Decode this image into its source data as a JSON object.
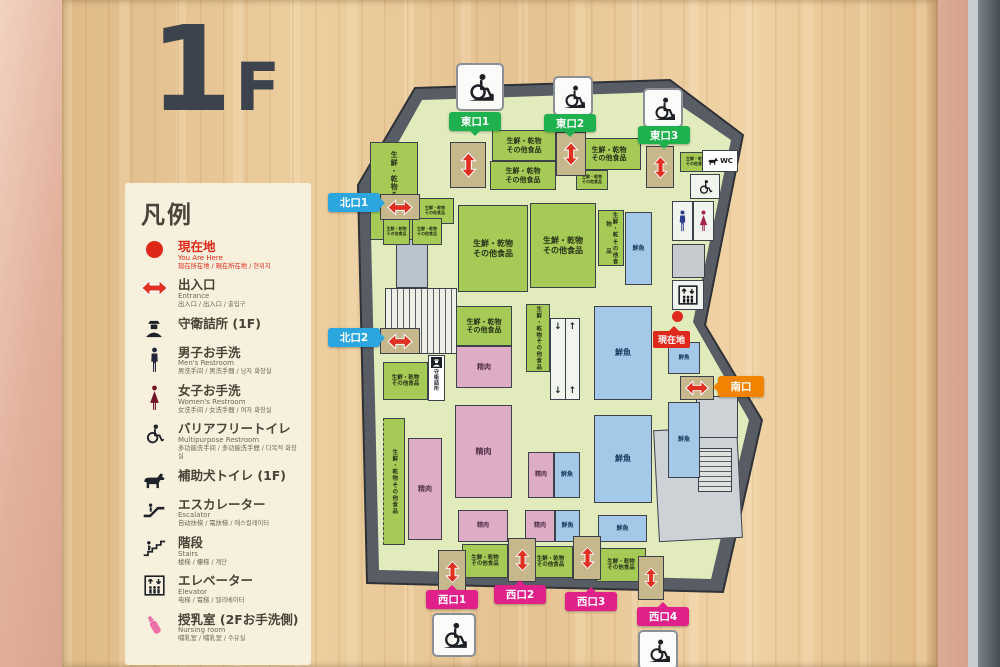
{
  "floor": {
    "big": "1",
    "small": "F"
  },
  "legend": {
    "title": "凡例",
    "items": [
      {
        "icon": "current-location",
        "label": "現在地",
        "sub_en": "You Are Here",
        "sub_multi": "现在所在地 / 現在所在地 / 현위치"
      },
      {
        "icon": "entrance",
        "label": "出入口",
        "sub_en": "Entrance",
        "sub_multi": "出入口 / 出入口 / 출입구"
      },
      {
        "icon": "guard",
        "label": "守衛詰所 (1F)"
      },
      {
        "icon": "mens-restroom",
        "label": "男子お手洗",
        "sub_en": "Men's Restroom",
        "sub_multi": "男洗手间 / 男洗手間 / 남자 화장실"
      },
      {
        "icon": "womens-restroom",
        "label": "女子お手洗",
        "sub_en": "Women's Restroom",
        "sub_multi": "女洗手间 / 女洗手間 / 여자 화장실"
      },
      {
        "icon": "barrier-free",
        "label": "バリアフリートイレ",
        "sub_en": "Multipurpose Restroom",
        "sub_multi": "多功能洗手间 / 多功能洗手間 / 다목적 화장실"
      },
      {
        "icon": "assist-dog",
        "label": "補助犬トイレ (1F)"
      },
      {
        "icon": "escalator",
        "label": "エスカレーター",
        "sub_en": "Escalator",
        "sub_multi": "自动扶梯 / 電扶梯 / 에스컬레이터"
      },
      {
        "icon": "stairs",
        "label": "階段",
        "sub_en": "Stairs",
        "sub_multi": "楼梯 / 樓梯 / 계단"
      },
      {
        "icon": "elevator",
        "label": "エレベーター",
        "sub_en": "Elevator",
        "sub_multi": "电梯 / 電梯 / 엘리베이터"
      },
      {
        "icon": "nursing",
        "label": "授乳室 (2Fお手洗側)",
        "sub_en": "Nursing room",
        "sub_multi": "哺乳室 / 哺乳室 / 수유실"
      }
    ]
  },
  "map": {
    "current_location": "現在地",
    "exits": {
      "east": [
        "東口1",
        "東口2",
        "東口3"
      ],
      "north": [
        "北口1",
        "北口2"
      ],
      "west": [
        "西口1",
        "西口2",
        "西口3",
        "西口4"
      ],
      "south": [
        "南口"
      ]
    },
    "areas": {
      "fresh1": "生鮮・乾物",
      "fresh2": "その他食品",
      "meat": "精肉",
      "fish": "鮮魚",
      "guard": "守衛詰所",
      "wc": "WC"
    },
    "colors": {
      "fresh_area": "#a5ca55",
      "meat_area": "#dfacc6",
      "fish_area": "#a3c8e8",
      "east_label": "#1fb14d",
      "north_label": "#2ba6df",
      "west_label": "#e0218a",
      "south_label": "#f08300",
      "current": "#e0291d"
    }
  }
}
